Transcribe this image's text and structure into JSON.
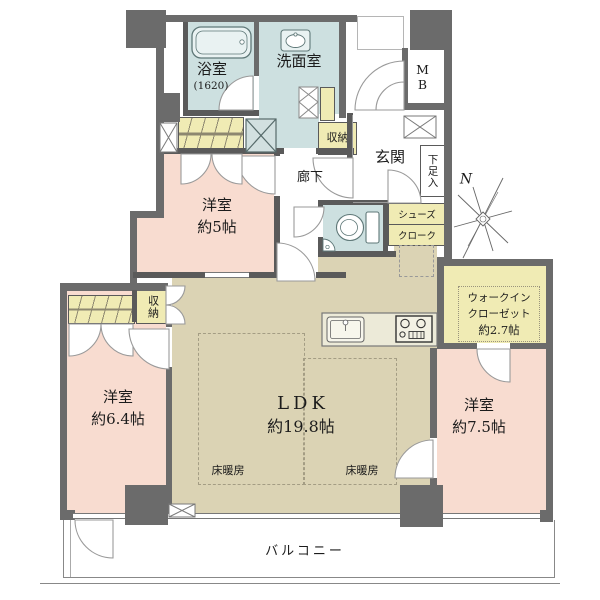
{
  "palette": {
    "wall": "#6b6b6b",
    "bedroom_pink": "#f8dcd0",
    "ldk_tan": "#dbd3b4",
    "wet_blue": "#cde0e0",
    "storage_yellow": "#f0ebb4"
  },
  "labels": {
    "bath_name": "浴室",
    "bath_size": "(1620)",
    "washroom": "洗面室",
    "mb": "MB",
    "hall_storage": "収納",
    "entrance": "玄関",
    "shoe_cabinet": "下足入",
    "corridor": "廊下",
    "bedroom5_name": "洋室",
    "bedroom5_size": "約5帖",
    "shoes_cloak_1": "シューズ",
    "shoes_cloak_2": "クローク",
    "west_storage": "収納",
    "bedroom64_name": "洋室",
    "bedroom64_size": "約6.4帖",
    "ldk_name": "LDK",
    "ldk_size": "約19.8帖",
    "floor_heating_left": "床暖房",
    "floor_heating_right": "床暖房",
    "wic_line1": "ウォークイン",
    "wic_line2": "クローゼット",
    "wic_line3": "約2.7帖",
    "bedroom75_name": "洋室",
    "bedroom75_size": "約7.5帖",
    "balcony": "バルコニー",
    "compass_n": "N"
  }
}
